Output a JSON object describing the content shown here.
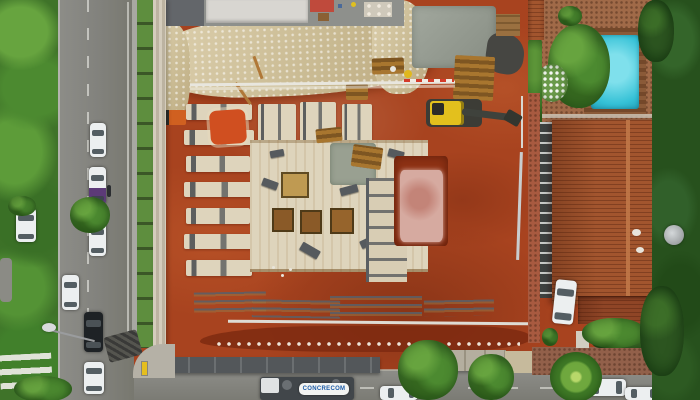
{
  "scene": {
    "type": "aerial-drone-photo",
    "description": "Top-down aerial photograph of an urban building construction site with red excavated earth, concrete foundations and formwork, a tracked excavator, a tree-lined road with parked cars on the left, a residential house with terracotta tile roof and backyard swimming pool on the right, and a bottom street with a concrete company truck."
  },
  "truck": {
    "banner_text": "CONCRECOM"
  },
  "palette": {
    "dirt": "#a8431f",
    "dirt-dark": "#7e2a10",
    "sand": "#d3c09c",
    "slab": "#ded4bc",
    "concrete": "#979d93",
    "asphalt": "#878783",
    "tree": "#3f7329",
    "tree-light": "#67a43f",
    "tree-dark": "#27511d",
    "grass": "#5e8e3e",
    "fence": "#ccc4b2",
    "pool": "#35c1d6",
    "deck": "#7c4e2c",
    "patio": "#a06a48",
    "roof": "#a2552e",
    "roof-ridge": "#c07848",
    "excavator": "#e3c01d",
    "machine-dark": "#3c3c36",
    "puddle": "#d6aaa0",
    "banner-blue": "#1c5ca8",
    "car-white": "#eceff0",
    "car-black": "#1e2225",
    "van-purple": "#5c3a78",
    "hoarding-dark": "#53575a",
    "hoarding-light": "#b4ae9f",
    "bollard": "#e5be1e"
  },
  "objects": [
    "construction-site-excavation",
    "concrete-foundation-slab",
    "footing-rows",
    "excavator",
    "survey-pole",
    "pink-water-puddle",
    "white-pipe",
    "left-road",
    "parked-cars",
    "street-lamp",
    "crosswalk",
    "construction-fence",
    "concrete-truck",
    "bottom-street",
    "house-roof",
    "swimming-pool",
    "pergola-walkway",
    "satellite-dish",
    "palm-tree",
    "hedges",
    "trees"
  ]
}
